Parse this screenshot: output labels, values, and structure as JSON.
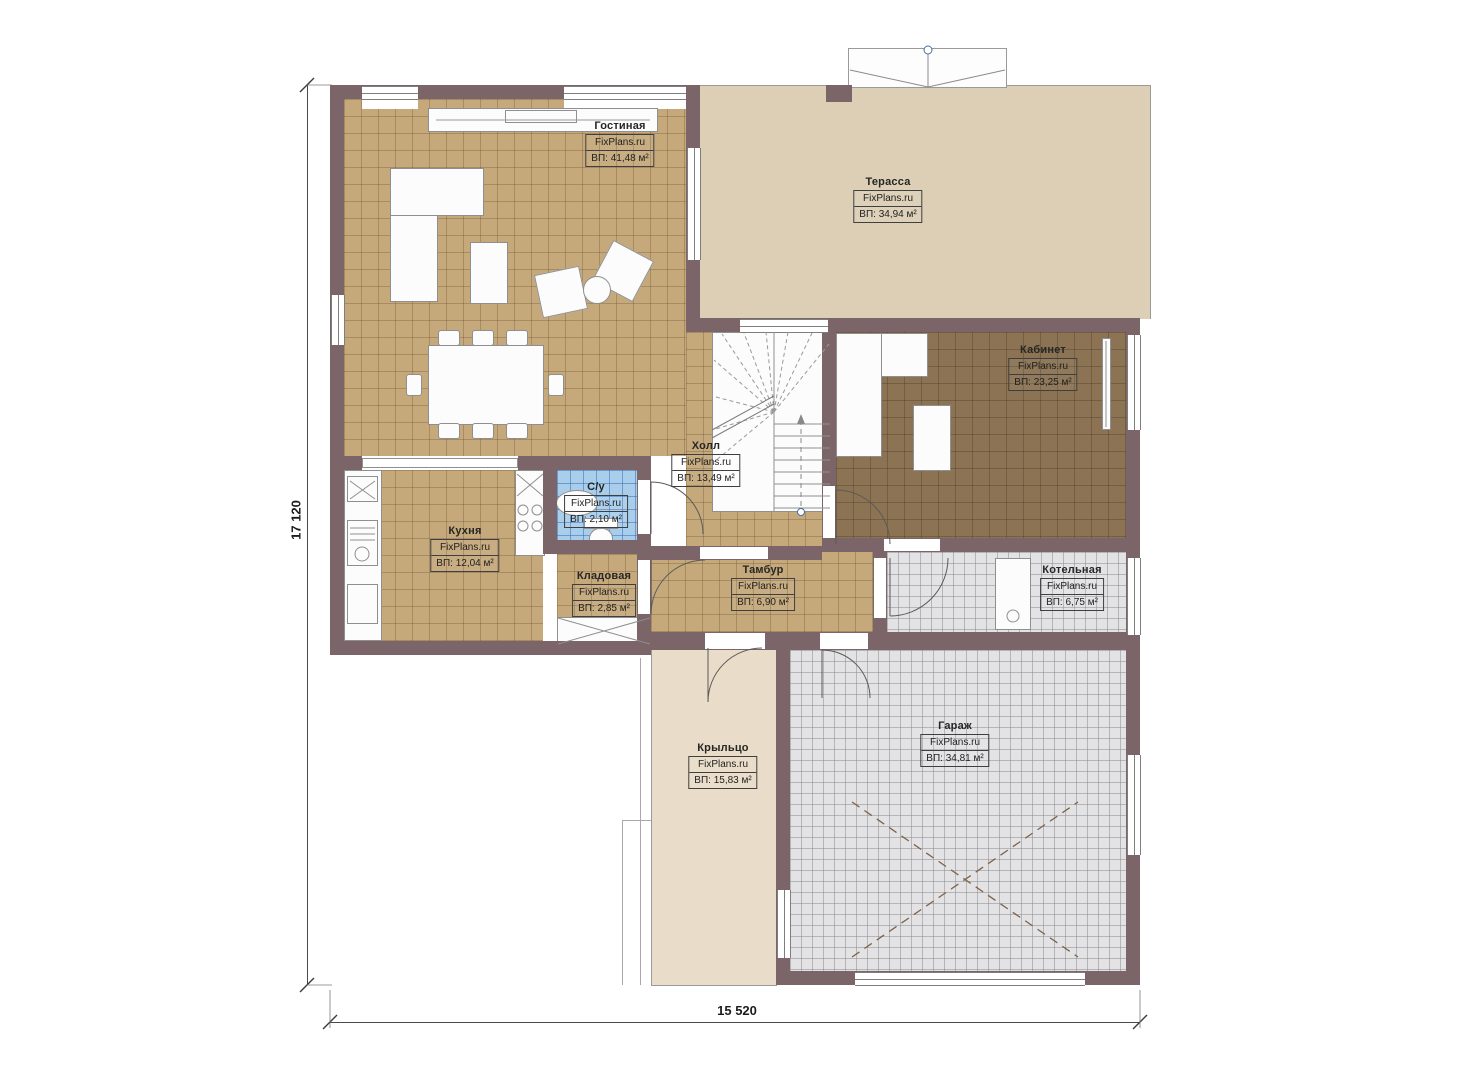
{
  "plan": {
    "watermark": "FixPlans.ru",
    "dimensions": {
      "left": "17 120",
      "bottom": "15 520"
    },
    "rooms": [
      {
        "id": "living",
        "name": "Гостиная",
        "watermark": "FixPlans.ru",
        "area": "ВП: 41,48 м²"
      },
      {
        "id": "terrace",
        "name": "Терасса",
        "watermark": "FixPlans.ru",
        "area": "ВП: 34,94 м²"
      },
      {
        "id": "office",
        "name": "Кабинет",
        "watermark": "FixPlans.ru",
        "area": "ВП: 23,25 м²"
      },
      {
        "id": "hall",
        "name": "Холл",
        "watermark": "FixPlans.ru",
        "area": "ВП: 13,49 м²"
      },
      {
        "id": "bathroom",
        "name": "С/у",
        "watermark": "FixPlans.ru",
        "area": "ВП: 2,10 м²"
      },
      {
        "id": "kitchen",
        "name": "Кухня",
        "watermark": "FixPlans.ru",
        "area": "ВП: 12,04 м²"
      },
      {
        "id": "storage",
        "name": "Кладовая",
        "watermark": "FixPlans.ru",
        "area": "ВП: 2,85 м²"
      },
      {
        "id": "vestibule",
        "name": "Тамбур",
        "watermark": "FixPlans.ru",
        "area": "ВП: 6,90 м²"
      },
      {
        "id": "boiler",
        "name": "Котельная",
        "watermark": "FixPlans.ru",
        "area": "ВП: 6,75 м²"
      },
      {
        "id": "porch",
        "name": "Крыльцо",
        "watermark": "FixPlans.ru",
        "area": "ВП: 15,83 м²"
      },
      {
        "id": "garage",
        "name": "Гараж",
        "watermark": "FixPlans.ru",
        "area": "ВП: 34,81 м²"
      }
    ],
    "colors": {
      "wall": "#7b6568",
      "tan": "#c5a97b",
      "office": "#8b7353",
      "blue": "#a9ceec",
      "gray": "#e3e3e5",
      "terrace": "#dccfb6",
      "porch": "#e9dcc8"
    },
    "icons": [
      "sofa-icon",
      "coffee-table-icon",
      "armchair-icon",
      "round-table-icon",
      "dining-table-icon",
      "chair-icon",
      "tv-console-icon",
      "staircase-icon",
      "desk-icon",
      "radiator-icon",
      "kitchen-counter-icon",
      "sink-icon",
      "stove-icon",
      "toilet-icon",
      "washbasin-icon",
      "boiler-unit-icon",
      "shelf-icon",
      "parking-cross-icon",
      "roof-valley-icon",
      "door-arc-icon"
    ]
  }
}
